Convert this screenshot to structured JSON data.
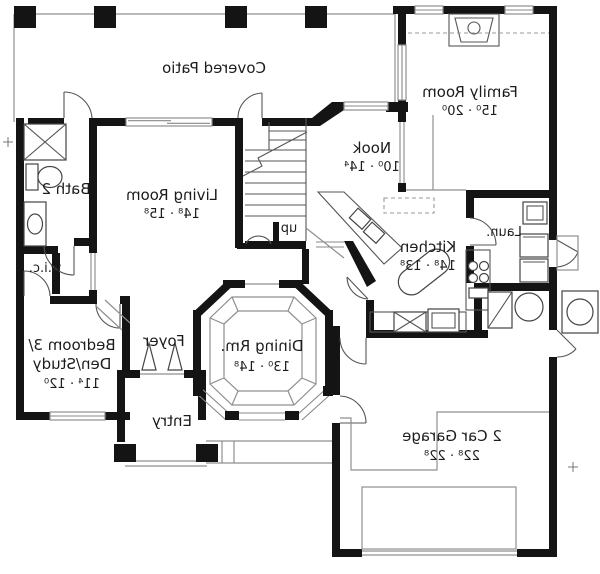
{
  "plan": {
    "rooms": {
      "covered_patio": {
        "name": "Covered Patio"
      },
      "family_room": {
        "name": "Family Room",
        "dims": "15⁰ · 20⁰"
      },
      "nook": {
        "name": "Nook",
        "dims": "10⁰ · 14⁴"
      },
      "living_room": {
        "name": "Living Room",
        "dims": "14⁸ · 15⁸"
      },
      "bath_2": {
        "name": "Bath 2"
      },
      "wic": {
        "name": "w.i.c."
      },
      "kitchen": {
        "name": "Kitchen",
        "dims": "14⁸ · 13⁸"
      },
      "laundry": {
        "name": "Laun."
      },
      "bedroom_3": {
        "name_line1": "Bedroom 3/",
        "name_line2": "Den/Study",
        "dims": "11⁴ · 12⁰"
      },
      "foyer": {
        "name": "Foyer"
      },
      "dining_room": {
        "name": "Dining Rm.",
        "dims": "13⁰ · 14⁸"
      },
      "entry": {
        "name": "Entry"
      },
      "garage": {
        "name": "2 Car Garage",
        "dims": "22⁸ · 22⁸"
      },
      "stairs": {
        "label": "up"
      }
    },
    "fixtures": [
      "fireplace",
      "shower",
      "toilet",
      "vanity-sink",
      "stairs",
      "kitchen-island",
      "range-cooktop",
      "refrigerator",
      "pantry",
      "double-sink",
      "dishwasher",
      "washer-dryer",
      "utility-sink",
      "water-heater",
      "furnace",
      "ac-pad",
      "garage-door",
      "front-double-door",
      "entry-pillars",
      "patio-pillars",
      "dining-tray-ceiling"
    ],
    "colors": {
      "wall": "#141414",
      "thin_line": "#8f8f8f",
      "fixture_line": "#444444",
      "background": "#ffffff",
      "text": "#1c1c1c"
    }
  }
}
